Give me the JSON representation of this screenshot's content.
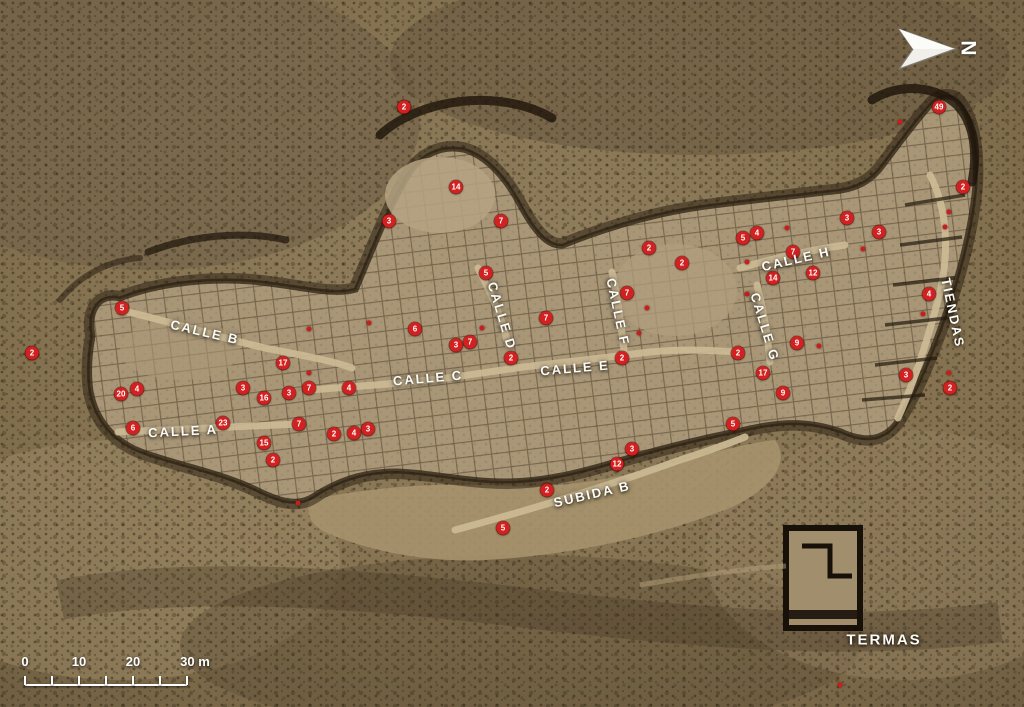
{
  "map": {
    "site_type": "aerial-archaeological-plan",
    "colors": {
      "marker": "#d32121",
      "dot": "#c81e1e",
      "label": "#fdfbf4"
    }
  },
  "north": {
    "label": "N"
  },
  "scale_bar": {
    "x": 25,
    "y": 684,
    "length": 162,
    "tick_count": 7,
    "labels": [
      {
        "text": "0",
        "tick": 0
      },
      {
        "text": "10",
        "tick": 2
      },
      {
        "text": "20",
        "tick": 4
      },
      {
        "text": "30 m",
        "tick": 6
      }
    ]
  },
  "streets": [
    {
      "label": "CALLE A",
      "x": 183,
      "y": 431,
      "angle": -3,
      "big": false
    },
    {
      "label": "CALLE B",
      "x": 205,
      "y": 332,
      "angle": 13,
      "big": false
    },
    {
      "label": "CALLE C",
      "x": 428,
      "y": 378,
      "angle": -5,
      "big": false
    },
    {
      "label": "CALLE D",
      "x": 502,
      "y": 316,
      "angle": 73,
      "big": false
    },
    {
      "label": "CALLE E",
      "x": 575,
      "y": 368,
      "angle": -5,
      "big": false
    },
    {
      "label": "CALLE F",
      "x": 618,
      "y": 312,
      "angle": 78,
      "big": false
    },
    {
      "label": "CALLE G",
      "x": 765,
      "y": 327,
      "angle": 73,
      "big": false
    },
    {
      "label": "CALLE H",
      "x": 796,
      "y": 259,
      "angle": -13,
      "big": false
    },
    {
      "label": "TIENDAS",
      "x": 953,
      "y": 313,
      "angle": 78,
      "big": false
    },
    {
      "label": "SUBIDA B",
      "x": 592,
      "y": 494,
      "angle": -13,
      "big": false
    },
    {
      "label": "TERMAS",
      "x": 884,
      "y": 640,
      "angle": 0,
      "big": true
    }
  ],
  "markers": [
    {
      "n": "2",
      "x": 404,
      "y": 107
    },
    {
      "n": "14",
      "x": 456,
      "y": 187
    },
    {
      "n": "3",
      "x": 389,
      "y": 221
    },
    {
      "n": "7",
      "x": 501,
      "y": 221
    },
    {
      "n": "5",
      "x": 486,
      "y": 273
    },
    {
      "n": "5",
      "x": 122,
      "y": 308
    },
    {
      "n": "2",
      "x": 32,
      "y": 353
    },
    {
      "n": "4",
      "x": 137,
      "y": 389
    },
    {
      "n": "20",
      "x": 121,
      "y": 394
    },
    {
      "n": "6",
      "x": 133,
      "y": 428
    },
    {
      "n": "17",
      "x": 283,
      "y": 363
    },
    {
      "n": "3",
      "x": 243,
      "y": 388
    },
    {
      "n": "16",
      "x": 264,
      "y": 398
    },
    {
      "n": "3",
      "x": 289,
      "y": 393
    },
    {
      "n": "7",
      "x": 309,
      "y": 388
    },
    {
      "n": "23",
      "x": 223,
      "y": 423
    },
    {
      "n": "15",
      "x": 264,
      "y": 443
    },
    {
      "n": "2",
      "x": 273,
      "y": 460
    },
    {
      "n": "7",
      "x": 299,
      "y": 424
    },
    {
      "n": "2",
      "x": 334,
      "y": 434
    },
    {
      "n": "4",
      "x": 354,
      "y": 433
    },
    {
      "n": "3",
      "x": 368,
      "y": 429
    },
    {
      "n": "4",
      "x": 349,
      "y": 388
    },
    {
      "n": "6",
      "x": 415,
      "y": 329
    },
    {
      "n": "3",
      "x": 456,
      "y": 345
    },
    {
      "n": "7",
      "x": 470,
      "y": 342
    },
    {
      "n": "2",
      "x": 511,
      "y": 358
    },
    {
      "n": "7",
      "x": 546,
      "y": 318
    },
    {
      "n": "7",
      "x": 627,
      "y": 293
    },
    {
      "n": "2",
      "x": 622,
      "y": 358
    },
    {
      "n": "2",
      "x": 649,
      "y": 248
    },
    {
      "n": "2",
      "x": 682,
      "y": 263
    },
    {
      "n": "5",
      "x": 743,
      "y": 238
    },
    {
      "n": "4",
      "x": 757,
      "y": 233
    },
    {
      "n": "7",
      "x": 793,
      "y": 252
    },
    {
      "n": "14",
      "x": 773,
      "y": 278
    },
    {
      "n": "12",
      "x": 813,
      "y": 273
    },
    {
      "n": "3",
      "x": 847,
      "y": 218
    },
    {
      "n": "3",
      "x": 879,
      "y": 232
    },
    {
      "n": "2",
      "x": 963,
      "y": 187
    },
    {
      "n": "49",
      "x": 939,
      "y": 107
    },
    {
      "n": "4",
      "x": 929,
      "y": 294
    },
    {
      "n": "3",
      "x": 906,
      "y": 375
    },
    {
      "n": "2",
      "x": 950,
      "y": 388
    },
    {
      "n": "2",
      "x": 738,
      "y": 353
    },
    {
      "n": "17",
      "x": 763,
      "y": 373
    },
    {
      "n": "9",
      "x": 797,
      "y": 343
    },
    {
      "n": "9",
      "x": 783,
      "y": 393
    },
    {
      "n": "5",
      "x": 733,
      "y": 424
    },
    {
      "n": "3",
      "x": 632,
      "y": 449
    },
    {
      "n": "12",
      "x": 617,
      "y": 464
    },
    {
      "n": "2",
      "x": 547,
      "y": 490
    },
    {
      "n": "5",
      "x": 503,
      "y": 528
    }
  ],
  "dots": [
    {
      "x": 369,
      "y": 323
    },
    {
      "x": 482,
      "y": 328
    },
    {
      "x": 309,
      "y": 329
    },
    {
      "x": 309,
      "y": 373
    },
    {
      "x": 647,
      "y": 308
    },
    {
      "x": 639,
      "y": 333
    },
    {
      "x": 747,
      "y": 262
    },
    {
      "x": 747,
      "y": 294
    },
    {
      "x": 787,
      "y": 228
    },
    {
      "x": 863,
      "y": 249
    },
    {
      "x": 900,
      "y": 122
    },
    {
      "x": 949,
      "y": 212
    },
    {
      "x": 945,
      "y": 227
    },
    {
      "x": 923,
      "y": 314
    },
    {
      "x": 819,
      "y": 346
    },
    {
      "x": 949,
      "y": 373
    },
    {
      "x": 298,
      "y": 503
    },
    {
      "x": 840,
      "y": 685
    }
  ]
}
